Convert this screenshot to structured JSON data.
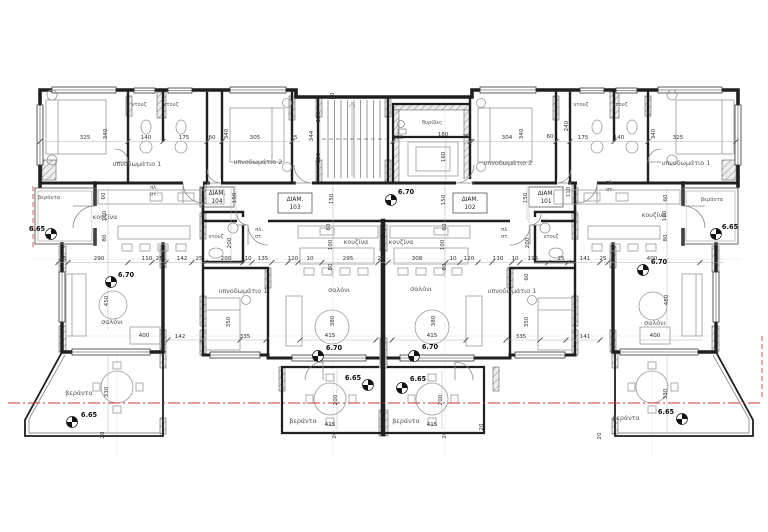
{
  "drawing": {
    "type": "architectural-floor-plan",
    "levels_shown": [
      "6.70",
      "6.65"
    ],
    "apartment_ids": [
      "101",
      "102",
      "103",
      "104"
    ]
  },
  "colors": {
    "wall": "#1f1f1f",
    "section_line": "#cc3333",
    "dim_text": "#333333",
    "room_text": "#555555"
  },
  "labels": [
    {
      "t": "υπνοδωμάτιο 1",
      "x": 137,
      "y": 166,
      "k": "room"
    },
    {
      "t": "υπνοδωμάτιο 2",
      "x": 258,
      "y": 164,
      "k": "room"
    },
    {
      "t": "υπνοδωμάτιο 2",
      "x": 508,
      "y": 165,
      "k": "room"
    },
    {
      "t": "υπνοδωμάτιο 1",
      "x": 686,
      "y": 165,
      "k": "room"
    },
    {
      "t": "υπνοδωμάτιο 1",
      "x": 243,
      "y": 293,
      "k": "room"
    },
    {
      "t": "υπνοδωμάτιο 1",
      "x": 512,
      "y": 293,
      "k": "room"
    },
    {
      "t": "σαλόνι",
      "x": 112,
      "y": 324,
      "k": "room"
    },
    {
      "t": "σαλόνι",
      "x": 339,
      "y": 292,
      "k": "room"
    },
    {
      "t": "σαλόνι",
      "x": 421,
      "y": 291,
      "k": "room"
    },
    {
      "t": "σαλόνι",
      "x": 655,
      "y": 325,
      "k": "room"
    },
    {
      "t": "κουζίνα",
      "x": 105,
      "y": 219,
      "k": "room"
    },
    {
      "t": "κουζίνα",
      "x": 356,
      "y": 244,
      "k": "room"
    },
    {
      "t": "κουζίνα",
      "x": 401,
      "y": 244,
      "k": "room"
    },
    {
      "t": "κουζίνα",
      "x": 654,
      "y": 217,
      "k": "room"
    },
    {
      "t": "βεράντα",
      "x": 49,
      "y": 199,
      "k": "small"
    },
    {
      "t": "βεράντα",
      "x": 712,
      "y": 201,
      "k": "small"
    },
    {
      "t": "βεράντα",
      "x": 79,
      "y": 395,
      "k": "room"
    },
    {
      "t": "βεράντα",
      "x": 303,
      "y": 423,
      "k": "room"
    },
    {
      "t": "βεράντα",
      "x": 406,
      "y": 423,
      "k": "room"
    },
    {
      "t": "βεράντα",
      "x": 626,
      "y": 420,
      "k": "room"
    },
    {
      "t": "ντουζ",
      "x": 139,
      "y": 106,
      "k": "small"
    },
    {
      "t": "ντουζ",
      "x": 171,
      "y": 106,
      "k": "small"
    },
    {
      "t": "ντουζ",
      "x": 581,
      "y": 106,
      "k": "small"
    },
    {
      "t": "ντουζ",
      "x": 620,
      "y": 106,
      "k": "small"
    },
    {
      "t": "ντουζ",
      "x": 216,
      "y": 238,
      "k": "small"
    },
    {
      "t": "ντουζ",
      "x": 551,
      "y": 238,
      "k": "small"
    },
    {
      "t": "θυρίδες",
      "x": 432,
      "y": 124,
      "k": "small"
    },
    {
      "t": "πλ.",
      "x": 154,
      "y": 189,
      "k": "small"
    },
    {
      "t": "στ.",
      "x": 154,
      "y": 196,
      "k": "small"
    },
    {
      "t": "πλ.",
      "x": 610,
      "y": 184,
      "k": "small"
    },
    {
      "t": "στ.",
      "x": 610,
      "y": 191,
      "k": "small"
    },
    {
      "t": "πλ.",
      "x": 259,
      "y": 231,
      "k": "small"
    },
    {
      "t": "στ.",
      "x": 259,
      "y": 238,
      "k": "small"
    },
    {
      "t": "πλ.",
      "x": 505,
      "y": 231,
      "k": "small"
    },
    {
      "t": "στ.",
      "x": 505,
      "y": 238,
      "k": "small"
    },
    {
      "t": "ΔΙΑΜ.",
      "x": 217,
      "y": 195,
      "k": "apt"
    },
    {
      "t": "104",
      "x": 217,
      "y": 203,
      "k": "apt"
    },
    {
      "t": "ΔΙΑΜ.",
      "x": 295,
      "y": 201,
      "k": "apt"
    },
    {
      "t": "103",
      "x": 295,
      "y": 209,
      "k": "apt"
    },
    {
      "t": "ΔΙΑΜ.",
      "x": 470,
      "y": 201,
      "k": "apt"
    },
    {
      "t": "102",
      "x": 470,
      "y": 209,
      "k": "apt"
    },
    {
      "t": "ΔΙΑΜ.",
      "x": 546,
      "y": 195,
      "k": "apt"
    },
    {
      "t": "101",
      "x": 546,
      "y": 203,
      "k": "apt"
    },
    {
      "t": "325",
      "x": 85,
      "y": 139
    },
    {
      "t": "340",
      "x": 107,
      "y": 134,
      "r": -90
    },
    {
      "t": "140",
      "x": 146,
      "y": 139
    },
    {
      "t": "175",
      "x": 184,
      "y": 139
    },
    {
      "t": "60",
      "x": 212,
      "y": 139
    },
    {
      "t": "340",
      "x": 228,
      "y": 134,
      "r": -90
    },
    {
      "t": "305",
      "x": 255,
      "y": 139
    },
    {
      "t": "25",
      "x": 294,
      "y": 139
    },
    {
      "t": "80",
      "x": 334,
      "y": 96,
      "r": -90
    },
    {
      "t": "120",
      "x": 320,
      "y": 117,
      "r": -90
    },
    {
      "t": "344",
      "x": 313,
      "y": 136,
      "r": -90
    },
    {
      "t": "120",
      "x": 320,
      "y": 158,
      "r": -90
    },
    {
      "t": "180",
      "x": 398,
      "y": 139
    },
    {
      "t": "180",
      "x": 443,
      "y": 136
    },
    {
      "t": "160",
      "x": 445,
      "y": 157,
      "r": -90
    },
    {
      "t": "25",
      "x": 466,
      "y": 138
    },
    {
      "t": "304",
      "x": 507,
      "y": 139
    },
    {
      "t": "340",
      "x": 523,
      "y": 134,
      "r": -90
    },
    {
      "t": "60",
      "x": 550,
      "y": 138
    },
    {
      "t": "240",
      "x": 568,
      "y": 126,
      "r": -90
    },
    {
      "t": "175",
      "x": 583,
      "y": 139
    },
    {
      "t": "140",
      "x": 619,
      "y": 139
    },
    {
      "t": "340",
      "x": 655,
      "y": 134,
      "r": -90
    },
    {
      "t": "325",
      "x": 678,
      "y": 139
    },
    {
      "t": "150",
      "x": 236,
      "y": 198,
      "r": -90
    },
    {
      "t": "150",
      "x": 333,
      "y": 199,
      "r": -90
    },
    {
      "t": "150",
      "x": 445,
      "y": 200,
      "r": -90
    },
    {
      "t": "150",
      "x": 527,
      "y": 198,
      "r": -90
    },
    {
      "t": "110",
      "x": 570,
      "y": 192,
      "r": -90
    },
    {
      "t": "60",
      "x": 105,
      "y": 196,
      "r": -90
    },
    {
      "t": "100",
      "x": 106,
      "y": 216,
      "r": -90
    },
    {
      "t": "80",
      "x": 106,
      "y": 238,
      "r": -90
    },
    {
      "t": "60",
      "x": 667,
      "y": 198,
      "r": -90
    },
    {
      "t": "100",
      "x": 666,
      "y": 216,
      "r": -90
    },
    {
      "t": "80",
      "x": 667,
      "y": 238,
      "r": -90
    },
    {
      "t": "60",
      "x": 330,
      "y": 227,
      "r": -90
    },
    {
      "t": "100",
      "x": 332,
      "y": 245,
      "r": -90
    },
    {
      "t": "80",
      "x": 332,
      "y": 267,
      "r": -90
    },
    {
      "t": "60",
      "x": 446,
      "y": 227,
      "r": -90
    },
    {
      "t": "100",
      "x": 444,
      "y": 245,
      "r": -90
    },
    {
      "t": "80",
      "x": 446,
      "y": 267,
      "r": -90
    },
    {
      "t": "200",
      "x": 231,
      "y": 243,
      "r": -90
    },
    {
      "t": "200",
      "x": 529,
      "y": 243,
      "r": -90
    },
    {
      "t": "60",
      "x": 528,
      "y": 277,
      "r": -90
    },
    {
      "t": "25",
      "x": 63,
      "y": 260
    },
    {
      "t": "290",
      "x": 99,
      "y": 260
    },
    {
      "t": "110",
      "x": 147,
      "y": 260
    },
    {
      "t": "25",
      "x": 159,
      "y": 260
    },
    {
      "t": "142",
      "x": 182,
      "y": 260
    },
    {
      "t": "25",
      "x": 199,
      "y": 260
    },
    {
      "t": "200",
      "x": 226,
      "y": 260
    },
    {
      "t": "10",
      "x": 248,
      "y": 260
    },
    {
      "t": "135",
      "x": 263,
      "y": 260
    },
    {
      "t": "120",
      "x": 293,
      "y": 260
    },
    {
      "t": "10",
      "x": 310,
      "y": 260
    },
    {
      "t": "295",
      "x": 348,
      "y": 260
    },
    {
      "t": "25",
      "x": 381,
      "y": 260
    },
    {
      "t": "308",
      "x": 417,
      "y": 260
    },
    {
      "t": "10",
      "x": 453,
      "y": 260
    },
    {
      "t": "120",
      "x": 469,
      "y": 260
    },
    {
      "t": "130",
      "x": 498,
      "y": 260
    },
    {
      "t": "10",
      "x": 515,
      "y": 260
    },
    {
      "t": "195",
      "x": 533,
      "y": 260
    },
    {
      "t": "25",
      "x": 561,
      "y": 260
    },
    {
      "t": "141",
      "x": 585,
      "y": 260
    },
    {
      "t": "25",
      "x": 603,
      "y": 260
    },
    {
      "t": "400",
      "x": 652,
      "y": 260
    },
    {
      "t": "142",
      "x": 180,
      "y": 338
    },
    {
      "t": "335",
      "x": 245,
      "y": 338
    },
    {
      "t": "415",
      "x": 330,
      "y": 337
    },
    {
      "t": "415",
      "x": 432,
      "y": 337
    },
    {
      "t": "335",
      "x": 521,
      "y": 338
    },
    {
      "t": "141",
      "x": 585,
      "y": 338
    },
    {
      "t": "350",
      "x": 230,
      "y": 322,
      "r": -90
    },
    {
      "t": "380",
      "x": 334,
      "y": 321,
      "r": -90
    },
    {
      "t": "380",
      "x": 435,
      "y": 321,
      "r": -90
    },
    {
      "t": "350",
      "x": 528,
      "y": 322,
      "r": -90
    },
    {
      "t": "450",
      "x": 108,
      "y": 301,
      "r": -90
    },
    {
      "t": "450",
      "x": 668,
      "y": 300,
      "r": -90
    },
    {
      "t": "400",
      "x": 144,
      "y": 337
    },
    {
      "t": "400",
      "x": 655,
      "y": 337
    },
    {
      "t": "330",
      "x": 108,
      "y": 392,
      "r": -90
    },
    {
      "t": "200",
      "x": 337,
      "y": 400,
      "r": -90
    },
    {
      "t": "200",
      "x": 442,
      "y": 400,
      "r": -90
    },
    {
      "t": "330",
      "x": 667,
      "y": 394,
      "r": -90
    },
    {
      "t": "415",
      "x": 330,
      "y": 426
    },
    {
      "t": "415",
      "x": 432,
      "y": 426
    },
    {
      "t": "20",
      "x": 104,
      "y": 435,
      "r": -90
    },
    {
      "t": "20",
      "x": 336,
      "y": 435,
      "r": -90
    },
    {
      "t": "20",
      "x": 446,
      "y": 435,
      "r": -90
    },
    {
      "t": "20",
      "x": 483,
      "y": 427,
      "r": -90
    },
    {
      "t": "20",
      "x": 601,
      "y": 436,
      "r": -90
    }
  ],
  "levels": [
    {
      "v": "6.70",
      "x": 391,
      "y": 200,
      "lx": 406,
      "ly": 194
    },
    {
      "v": "6.70",
      "x": 111,
      "y": 282,
      "lx": 126,
      "ly": 277
    },
    {
      "v": "6.70",
      "x": 643,
      "y": 270,
      "lx": 659,
      "ly": 264
    },
    {
      "v": "6.70",
      "x": 318,
      "y": 356,
      "lx": 334,
      "ly": 350
    },
    {
      "v": "6.70",
      "x": 414,
      "y": 356,
      "lx": 430,
      "ly": 349
    },
    {
      "v": "6.65",
      "x": 368,
      "y": 385,
      "lx": 353,
      "ly": 380
    },
    {
      "v": "6.65",
      "x": 402,
      "y": 388,
      "lx": 418,
      "ly": 381
    },
    {
      "v": "6.65",
      "x": 72,
      "y": 422,
      "lx": 89,
      "ly": 417
    },
    {
      "v": "6.65",
      "x": 682,
      "y": 419,
      "lx": 666,
      "ly": 414
    },
    {
      "v": "6.65",
      "x": 51,
      "y": 234,
      "lx": 37,
      "ly": 231
    },
    {
      "v": "6.65",
      "x": 716,
      "y": 234,
      "lx": 730,
      "ly": 229
    }
  ]
}
